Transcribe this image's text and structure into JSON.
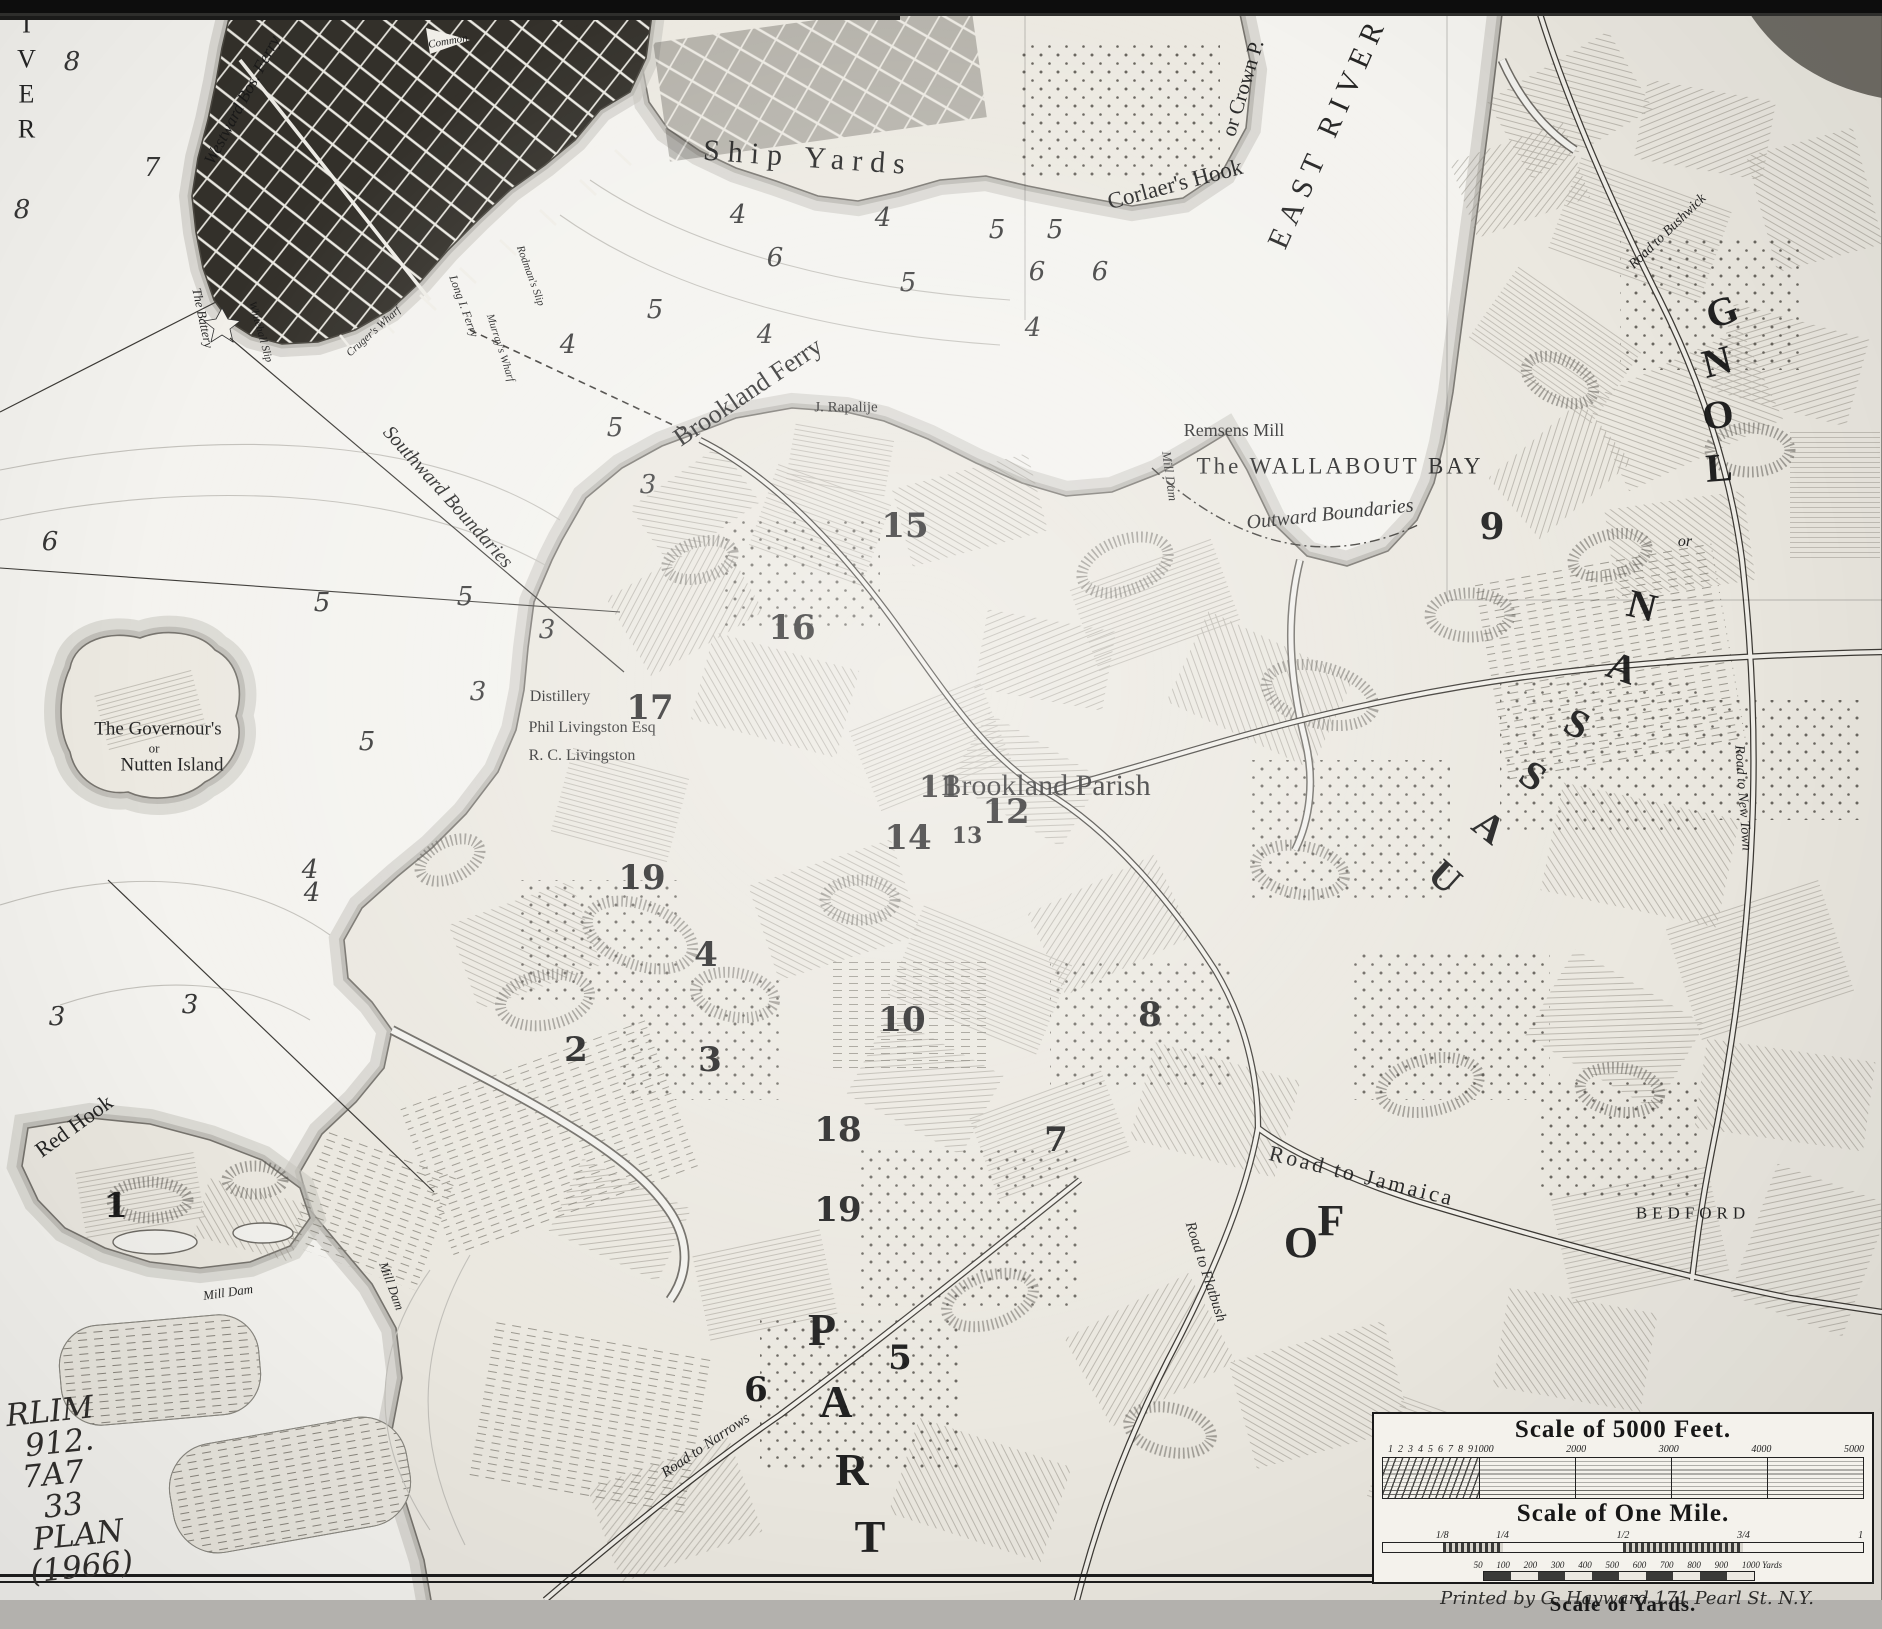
{
  "colors": {
    "ink": "#1b1b1b",
    "paper": "#efede8",
    "water": "#f6f5f1",
    "city": "#34312b"
  },
  "labels": [
    {
      "n": "label-river-west",
      "t": "RIVER",
      "x": 26,
      "y": 62,
      "s": 26,
      "c": "stack",
      "ls": 6
    },
    {
      "n": "label-east-river",
      "t": "EAST RIVER",
      "x": 1328,
      "y": 132,
      "r": -66,
      "s": 30,
      "ls": 8
    },
    {
      "n": "label-ship-yards",
      "t": "Ship Yards",
      "x": 808,
      "y": 158,
      "r": 4,
      "s": 30,
      "ls": 8
    },
    {
      "n": "label-corlaers-hook",
      "t": "Corlaer's Hook",
      "x": 1175,
      "y": 184,
      "r": -15,
      "s": 23
    },
    {
      "n": "label-or-crown-p",
      "t": "or Crown P.",
      "x": 1243,
      "y": 88,
      "r": -73,
      "s": 21
    },
    {
      "n": "label-wallabout-bay",
      "t": "The WALLABOUT  BAY",
      "x": 1340,
      "y": 466,
      "s": 23,
      "ls": 3
    },
    {
      "n": "label-outward-boundaries",
      "t": "Outward Boundaries",
      "x": 1330,
      "y": 514,
      "r": -6,
      "s": 20,
      "c": "it"
    },
    {
      "n": "label-southward-boundaries",
      "t": "Southward Boundaries",
      "x": 448,
      "y": 497,
      "r": 48,
      "s": 20,
      "c": "it"
    },
    {
      "n": "label-brookland-ferry",
      "t": "Brookland Ferry",
      "x": 748,
      "y": 392,
      "r": -34,
      "s": 26
    },
    {
      "n": "label-j-rapalije",
      "t": "J. Rapalije",
      "x": 846,
      "y": 408,
      "s": 15
    },
    {
      "n": "label-remsens-mill",
      "t": "Remsens Mill",
      "x": 1234,
      "y": 430,
      "s": 18
    },
    {
      "n": "label-governours-island-1",
      "t": "The Governour's",
      "x": 158,
      "y": 729,
      "s": 19
    },
    {
      "n": "label-governours-island-2",
      "t": "or",
      "x": 154,
      "y": 748,
      "s": 13
    },
    {
      "n": "label-governours-island-3",
      "t": "Nutten Island",
      "x": 172,
      "y": 765,
      "s": 19
    },
    {
      "n": "label-distillery",
      "t": "Distillery",
      "x": 560,
      "y": 697,
      "s": 16
    },
    {
      "n": "label-phil-livingston",
      "t": "Phil Livingston Esq",
      "x": 592,
      "y": 728,
      "s": 16
    },
    {
      "n": "label-rc-livingston",
      "t": "R. C. Livingston",
      "x": 582,
      "y": 756,
      "s": 16
    },
    {
      "n": "label-brookland-parish",
      "t": "Brookland Parish",
      "x": 1046,
      "y": 786,
      "s": 30
    },
    {
      "n": "label-red-hook",
      "t": "Red Hook",
      "x": 74,
      "y": 1126,
      "r": -36,
      "s": 22
    },
    {
      "n": "label-mill-dam-1",
      "t": "Mill Dam",
      "x": 228,
      "y": 1292,
      "r": -8,
      "s": 13,
      "c": "it"
    },
    {
      "n": "label-mill-dam-2",
      "t": "Mill Dam",
      "x": 392,
      "y": 1286,
      "r": 70,
      "s": 13,
      "c": "it"
    },
    {
      "n": "label-mill-dam-3",
      "t": "Mill Dam",
      "x": 1170,
      "y": 476,
      "r": 82,
      "s": 13,
      "c": "it"
    },
    {
      "n": "label-road-to-jamaica",
      "t": "Road to Jamaica",
      "x": 1362,
      "y": 1176,
      "r": 14,
      "s": 22,
      "ls": 3
    },
    {
      "n": "label-road-to-flatbush",
      "t": "Road to Flatbush",
      "x": 1205,
      "y": 1272,
      "r": 72,
      "s": 15,
      "c": "it"
    },
    {
      "n": "label-road-to-narrows",
      "t": "Road to Narrows",
      "x": 706,
      "y": 1446,
      "r": -34,
      "s": 15,
      "c": "it"
    },
    {
      "n": "label-road-to-new-town",
      "t": "Road to New Town",
      "x": 1742,
      "y": 798,
      "r": 86,
      "s": 14,
      "c": "it"
    },
    {
      "n": "label-road-to-bushwick",
      "t": "Road to Bushwick",
      "x": 1668,
      "y": 232,
      "r": -44,
      "s": 14,
      "c": "it"
    },
    {
      "n": "label-bedford",
      "t": "BEDFORD",
      "x": 1693,
      "y": 1213,
      "s": 17,
      "ls": 5
    },
    {
      "n": "label-westward-ferry",
      "t": "Westward Bos. Ferry",
      "x": 242,
      "y": 100,
      "r": -62,
      "s": 17,
      "c": "it"
    },
    {
      "n": "label-the-battery",
      "t": "The Battery",
      "x": 203,
      "y": 318,
      "r": 78,
      "s": 13,
      "c": "it"
    },
    {
      "n": "label-whitehall-slip",
      "t": "Whitehall Slip",
      "x": 260,
      "y": 332,
      "r": 74,
      "s": 11,
      "c": "it"
    },
    {
      "n": "label-crugers-wharf",
      "t": "Cruger's Wharf",
      "x": 374,
      "y": 332,
      "r": -42,
      "s": 11,
      "c": "it"
    },
    {
      "n": "label-murrays-wharf",
      "t": "Murray's Wharf",
      "x": 500,
      "y": 348,
      "r": 72,
      "s": 11,
      "c": "it"
    },
    {
      "n": "label-long-i-ferry",
      "t": "Long I. Ferry",
      "x": 464,
      "y": 306,
      "r": 70,
      "s": 12,
      "c": "it"
    },
    {
      "n": "label-rodmans-slip",
      "t": "Rodman's Slip",
      "x": 530,
      "y": 276,
      "r": 70,
      "s": 11,
      "c": "it"
    },
    {
      "n": "label-common",
      "t": "Common",
      "x": 448,
      "y": 42,
      "r": -10,
      "s": 11,
      "c": "it"
    },
    {
      "n": "letter-part-p",
      "t": "P",
      "x": 822,
      "y": 1330,
      "s": 46,
      "c": "g"
    },
    {
      "n": "letter-part-a",
      "t": "A",
      "x": 836,
      "y": 1402,
      "s": 46,
      "c": "g"
    },
    {
      "n": "letter-part-r",
      "t": "R",
      "x": 852,
      "y": 1470,
      "s": 46,
      "c": "g"
    },
    {
      "n": "letter-part-t",
      "t": "T",
      "x": 870,
      "y": 1537,
      "s": 46,
      "c": "g"
    },
    {
      "n": "letter-of-o",
      "t": "O",
      "x": 1301,
      "y": 1243,
      "s": 44,
      "c": "g"
    },
    {
      "n": "letter-of-f",
      "t": "F",
      "x": 1331,
      "y": 1221,
      "s": 44,
      "c": "g"
    },
    {
      "n": "letter-long-g",
      "t": "G",
      "x": 1722,
      "y": 312,
      "s": 40,
      "c": "g",
      "r": -20
    },
    {
      "n": "letter-long-n",
      "t": "N",
      "x": 1717,
      "y": 362,
      "s": 40,
      "c": "g",
      "r": -14
    },
    {
      "n": "letter-long-o",
      "t": "O",
      "x": 1718,
      "y": 415,
      "s": 40,
      "c": "g",
      "r": -8
    },
    {
      "n": "letter-long-l",
      "t": "L",
      "x": 1719,
      "y": 468,
      "s": 40,
      "c": "g",
      "r": -4
    },
    {
      "n": "label-or-nassau",
      "t": "or",
      "x": 1685,
      "y": 542,
      "s": 16,
      "c": "it"
    },
    {
      "n": "letter-nassau-n",
      "t": "N",
      "x": 1642,
      "y": 606,
      "s": 40,
      "c": "g",
      "r": 14
    },
    {
      "n": "letter-nassau-a1",
      "t": "A",
      "x": 1622,
      "y": 668,
      "s": 40,
      "c": "g",
      "r": 20
    },
    {
      "n": "letter-nassau-s1",
      "t": "S",
      "x": 1577,
      "y": 724,
      "s": 40,
      "c": "g",
      "r": 28
    },
    {
      "n": "letter-nassau-s2",
      "t": "S",
      "x": 1533,
      "y": 776,
      "s": 40,
      "c": "g",
      "r": 34
    },
    {
      "n": "letter-nassau-a2",
      "t": "A",
      "x": 1489,
      "y": 827,
      "s": 40,
      "c": "g",
      "r": 38
    },
    {
      "n": "letter-nassau-u",
      "t": "U",
      "x": 1445,
      "y": 877,
      "s": 40,
      "c": "g",
      "r": 42
    },
    {
      "n": "farm-number-1",
      "t": "1",
      "x": 116,
      "y": 1206,
      "s": 34,
      "c": "num"
    },
    {
      "n": "farm-number-2",
      "t": "2",
      "x": 576,
      "y": 1050,
      "s": 34,
      "c": "num"
    },
    {
      "n": "farm-number-3",
      "t": "3",
      "x": 710,
      "y": 1060,
      "s": 34,
      "c": "num"
    },
    {
      "n": "farm-number-4",
      "t": "4",
      "x": 706,
      "y": 955,
      "s": 34,
      "c": "num"
    },
    {
      "n": "farm-number-5",
      "t": "5",
      "x": 900,
      "y": 1358,
      "s": 34,
      "c": "num"
    },
    {
      "n": "farm-number-6",
      "t": "6",
      "x": 756,
      "y": 1390,
      "s": 34,
      "c": "num"
    },
    {
      "n": "farm-number-7",
      "t": "7",
      "x": 1056,
      "y": 1140,
      "s": 34,
      "c": "num"
    },
    {
      "n": "farm-number-8",
      "t": "8",
      "x": 1150,
      "y": 1015,
      "s": 34,
      "c": "num"
    },
    {
      "n": "farm-number-9",
      "t": "9",
      "x": 1492,
      "y": 527,
      "s": 36,
      "c": "num"
    },
    {
      "n": "farm-number-10",
      "t": "10",
      "x": 902,
      "y": 1020,
      "s": 34,
      "c": "num"
    },
    {
      "n": "farm-number-11",
      "t": "11",
      "x": 940,
      "y": 788,
      "s": 30,
      "c": "num"
    },
    {
      "n": "farm-number-12",
      "t": "12",
      "x": 1006,
      "y": 812,
      "s": 34,
      "c": "num"
    },
    {
      "n": "farm-number-13",
      "t": "13",
      "x": 967,
      "y": 836,
      "s": 22,
      "c": "num"
    },
    {
      "n": "farm-number-14",
      "t": "14",
      "x": 908,
      "y": 838,
      "s": 34,
      "c": "num"
    },
    {
      "n": "farm-number-15",
      "t": "15",
      "x": 905,
      "y": 526,
      "s": 34,
      "c": "num"
    },
    {
      "n": "farm-number-16",
      "t": "16",
      "x": 792,
      "y": 628,
      "s": 34,
      "c": "num"
    },
    {
      "n": "farm-number-17",
      "t": "17",
      "x": 650,
      "y": 708,
      "s": 34,
      "c": "num"
    },
    {
      "n": "farm-number-18",
      "t": "18",
      "x": 838,
      "y": 1130,
      "s": 34,
      "c": "num"
    },
    {
      "n": "farm-number-19a",
      "t": "19",
      "x": 642,
      "y": 878,
      "s": 34,
      "c": "num"
    },
    {
      "n": "farm-number-19b",
      "t": "19",
      "x": 838,
      "y": 1210,
      "s": 34,
      "c": "num"
    },
    {
      "n": "sounding",
      "t": "8",
      "x": 72,
      "y": 62,
      "s": 26,
      "c": "snd"
    },
    {
      "n": "sounding",
      "t": "7",
      "x": 152,
      "y": 168,
      "s": 26,
      "c": "snd"
    },
    {
      "n": "sounding",
      "t": "8",
      "x": 22,
      "y": 210,
      "s": 26,
      "c": "snd"
    },
    {
      "n": "sounding",
      "t": "4",
      "x": 738,
      "y": 215,
      "s": 26,
      "c": "snd"
    },
    {
      "n": "sounding",
      "t": "4",
      "x": 883,
      "y": 218,
      "s": 26,
      "c": "snd"
    },
    {
      "n": "sounding",
      "t": "5",
      "x": 997,
      "y": 230,
      "s": 26,
      "c": "snd"
    },
    {
      "n": "sounding",
      "t": "6",
      "x": 775,
      "y": 258,
      "s": 26,
      "c": "snd"
    },
    {
      "n": "sounding",
      "t": "5",
      "x": 908,
      "y": 283,
      "s": 26,
      "c": "snd"
    },
    {
      "n": "sounding",
      "t": "5",
      "x": 655,
      "y": 310,
      "s": 26,
      "c": "snd"
    },
    {
      "n": "sounding",
      "t": "6",
      "x": 1037,
      "y": 272,
      "s": 26,
      "c": "snd"
    },
    {
      "n": "sounding",
      "t": "4",
      "x": 1033,
      "y": 328,
      "s": 26,
      "c": "snd"
    },
    {
      "n": "sounding",
      "t": "5",
      "x": 1055,
      "y": 230,
      "s": 26,
      "c": "snd"
    },
    {
      "n": "sounding",
      "t": "6",
      "x": 1100,
      "y": 272,
      "s": 26,
      "c": "snd"
    },
    {
      "n": "sounding",
      "t": "4",
      "x": 765,
      "y": 335,
      "s": 26,
      "c": "snd"
    },
    {
      "n": "sounding",
      "t": "4",
      "x": 568,
      "y": 345,
      "s": 26,
      "c": "snd"
    },
    {
      "n": "sounding",
      "t": "5",
      "x": 615,
      "y": 428,
      "s": 26,
      "c": "snd"
    },
    {
      "n": "sounding",
      "t": "3",
      "x": 648,
      "y": 485,
      "s": 26,
      "c": "snd"
    },
    {
      "n": "sounding",
      "t": "5",
      "x": 322,
      "y": 603,
      "s": 26,
      "c": "snd"
    },
    {
      "n": "sounding",
      "t": "5",
      "x": 465,
      "y": 597,
      "s": 26,
      "c": "snd"
    },
    {
      "n": "sounding",
      "t": "3",
      "x": 547,
      "y": 630,
      "s": 26,
      "c": "snd"
    },
    {
      "n": "sounding",
      "t": "3",
      "x": 478,
      "y": 692,
      "s": 26,
      "c": "snd"
    },
    {
      "n": "sounding",
      "t": "5",
      "x": 367,
      "y": 742,
      "s": 26,
      "c": "snd"
    },
    {
      "n": "sounding",
      "t": "6",
      "x": 50,
      "y": 542,
      "s": 26,
      "c": "snd"
    },
    {
      "n": "sounding",
      "t": "4",
      "x": 310,
      "y": 870,
      "s": 26,
      "c": "snd"
    },
    {
      "n": "sounding",
      "t": "3",
      "x": 57,
      "y": 1017,
      "s": 26,
      "c": "snd"
    },
    {
      "n": "sounding",
      "t": "3",
      "x": 190,
      "y": 1005,
      "s": 26,
      "c": "snd"
    },
    {
      "n": "sounding",
      "t": "4",
      "x": 312,
      "y": 893,
      "s": 26,
      "c": "snd"
    }
  ],
  "scale_panel": {
    "feet": {
      "title": "Scale of 5000 Feet.",
      "ticks_left": [
        "1",
        "2",
        "3",
        "4",
        "5",
        "6",
        "7",
        "8",
        "9"
      ],
      "ticks_main": [
        "1000",
        "2000",
        "3000",
        "4000",
        "5000"
      ]
    },
    "mile": {
      "title": "Scale of One Mile.",
      "ticks": [
        "1/8",
        "1/4",
        "1/2",
        "3/4",
        "1"
      ]
    },
    "yards": {
      "title": "Scale of Yards.",
      "ticks": [
        "50",
        "100",
        "200",
        "300",
        "400",
        "500",
        "600",
        "700",
        "800",
        "900",
        "1000 Yards"
      ]
    },
    "imprint": "Printed by G. Hayward 171 Pearl St. N.Y."
  },
  "handwriting": {
    "lines": [
      "RLIM",
      "912.",
      "7A7",
      "33",
      "PLAN",
      "(1966)"
    ]
  }
}
